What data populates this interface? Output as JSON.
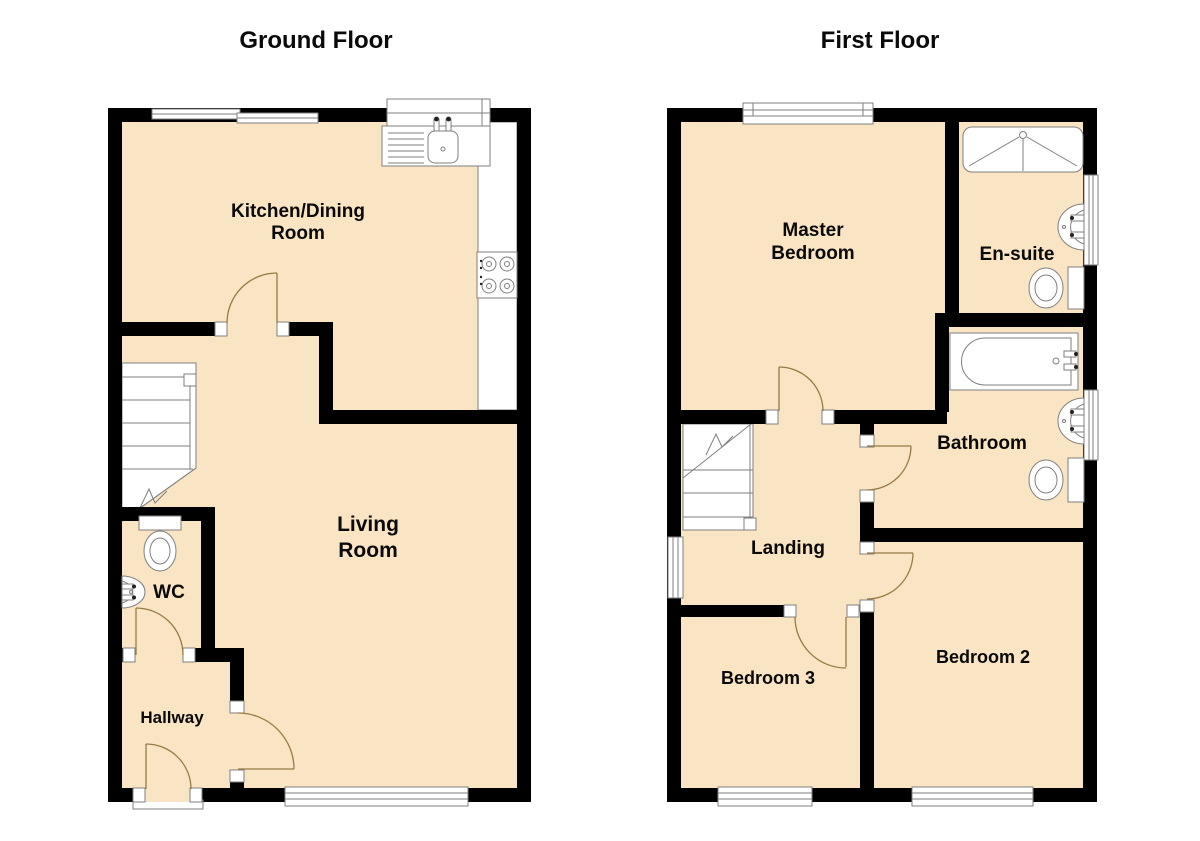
{
  "page": {
    "type": "floor-plan",
    "plans": [
      "Ground Floor",
      "First Floor"
    ]
  },
  "ground_floor": {
    "title": "Ground Floor",
    "rooms": [
      "Kitchen/Dining Room",
      "Living Room",
      "WC",
      "Hallway"
    ],
    "labels": {
      "kitchen": {
        "line1": "Kitchen/Dining",
        "line2": "Room"
      },
      "living": {
        "line1": "Living",
        "line2": "Room"
      },
      "wc": "WC",
      "hallway": "Hallway"
    }
  },
  "first_floor": {
    "title": "First Floor",
    "rooms": [
      "Master Bedroom",
      "En-suite",
      "Bathroom",
      "Landing",
      "Bedroom 2",
      "Bedroom 3"
    ],
    "labels": {
      "master": {
        "line1": "Master",
        "line2": "Bedroom"
      },
      "ensuite": "En-suite",
      "bathroom": "Bathroom",
      "landing": "Landing",
      "bedroom2": "Bedroom 2",
      "bedroom3": "Bedroom 3"
    }
  },
  "colors": {
    "wall": "#000000",
    "floor": "#f9e5c3",
    "outline": "#7f7f7f",
    "door": "#967b46"
  }
}
